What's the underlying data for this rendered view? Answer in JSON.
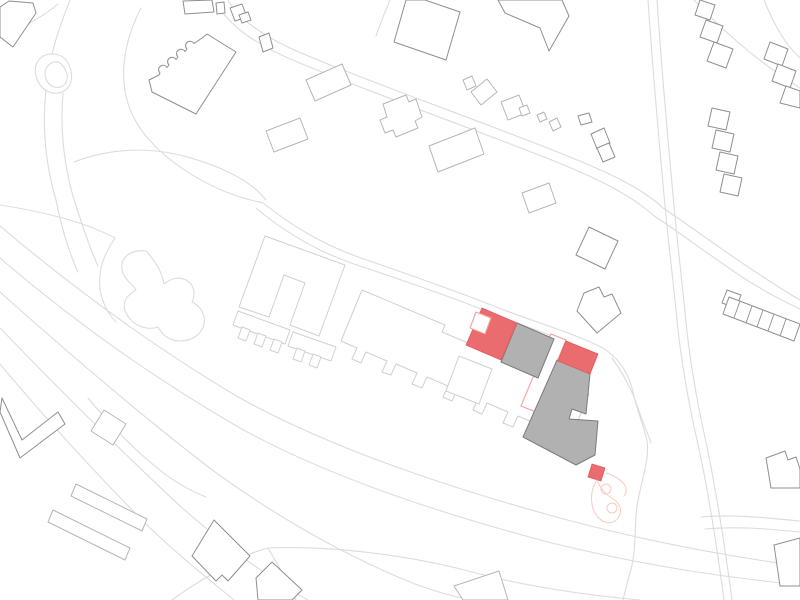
{
  "canvas": {
    "width": 800,
    "height": 600,
    "background": "#ffffff"
  },
  "palette": {
    "background": "#ffffff",
    "road_line": "#dcdcdc",
    "light_line": "#d0d0d0",
    "mid_line": "#b6b6b6",
    "dark_line": "#8f8f8f",
    "gray_fill": "#b1b1b1",
    "gray_stroke": "#7c7c7c",
    "red_fill": "#ea6c6e",
    "red_stroke": "#e05a5e",
    "salmon_line": "#efa49b",
    "pink_line": "#f6cabe"
  },
  "styles": {
    "road": {
      "stroke": "road_line",
      "fill": "none",
      "w": 1.1
    },
    "area": {
      "stroke": "road_line",
      "fill": "background",
      "w": 1.1
    },
    "light": {
      "stroke": "light_line",
      "fill": "background",
      "w": 1
    },
    "mid": {
      "stroke": "mid_line",
      "fill": "background",
      "w": 1
    },
    "dark": {
      "stroke": "dark_line",
      "fill": "background",
      "w": 1
    },
    "darkline": {
      "stroke": "dark_line",
      "fill": "none",
      "w": 0.9
    },
    "gray": {
      "stroke": "gray_stroke",
      "fill": "gray_fill",
      "w": 1
    },
    "red": {
      "stroke": "red_stroke",
      "fill": "red_fill",
      "w": 0.8
    },
    "salmon": {
      "stroke": "salmon_line",
      "fill": "background",
      "w": 1.1
    },
    "pink": {
      "stroke": "pink_line",
      "fill": "none",
      "w": 1
    }
  },
  "layers": [
    {
      "name": "roads",
      "items": [
        {
          "id": "road-approach-top-left",
          "style": "road",
          "d": "M 70,0 C 62,20 56,38 52,54"
        },
        {
          "id": "road-corner-line",
          "style": "road",
          "d": "M 0,38 C 22,28 44,16 58,4"
        },
        {
          "id": "road-culdesac-outer",
          "style": "road",
          "d": "M 52,54 C 40,54 33,64 36,76 C 39,89 51,96 62,92 C 72,88 74,76 69,65 C 66,58 60,54 52,54 Z"
        },
        {
          "id": "road-culdesac-island",
          "style": "road",
          "d": "M 54,62 C 47,64 43,71 46,79 C 49,87 58,90 64,85 C 69,81 68,72 63,66 C 60,62 57,61 54,62 Z"
        },
        {
          "id": "road-culdesac-stem-1",
          "style": "road",
          "d": "M 46,90 C 42,128 46,166 56,200 C 60,220 67,248 78,272"
        },
        {
          "id": "road-culdesac-stem-2",
          "style": "road",
          "d": "M 63,93 C 60,130 64,164 73,196 C 80,218 88,244 98,266"
        },
        {
          "id": "road-ring-around-kindergarten",
          "style": "road",
          "d": "M 141,8 C 122,45 117,85 134,118 C 150,149 190,179 234,195 C 245,199 255,201 263,203"
        },
        {
          "id": "road-path-upper",
          "style": "road",
          "d": "M 74,162 C 110,148 151,146 191,158 C 225,168 252,182 266,200"
        },
        {
          "id": "road-path-left-edge",
          "style": "road",
          "d": "M 0,205 C 45,212 85,222 115,238 C 108,249 101,261 100,275 C 98,292 104,310 116,322"
        },
        {
          "id": "road-main-street-1",
          "style": "road",
          "d": "M 228,0 C 236,16 261,36 301,53 C 380,86 480,121 560,153 C 600,169 640,186 663,208"
        },
        {
          "id": "road-main-street-2",
          "style": "road",
          "d": "M 218,5 C 228,24 254,44 295,61 C 374,94 474,129 554,161 C 594,177 630,194 653,215"
        },
        {
          "id": "road-main-street-1b",
          "style": "road",
          "d": "M 663,208 C 690,226 721,249 751,269 C 771,282 786,292 800,300"
        },
        {
          "id": "road-main-street-2b",
          "style": "road",
          "d": "M 653,215 C 680,233 711,256 742,277 C 762,290 781,300 800,309"
        },
        {
          "id": "road-branch-top",
          "style": "road",
          "d": "M 390,0 C 385,12 380,24 376,36"
        },
        {
          "id": "road-estate-1",
          "style": "road",
          "d": "M 263,203 C 291,225 321,244 361,258 C 401,272 451,289 491,305 C 531,321 571,332 601,347 C 619,357 629,374 633,392 C 637,411 644,426 647,441 C 650,459 641,481 637,506 C 634,527 637,553 629,576 C 627,584 625,592 623,600"
        },
        {
          "id": "road-estate-2",
          "style": "road",
          "d": "M 256,208 C 282,230 312,249 351,263 C 396,278 446,295 486,311 C 521,325 556,336 586,350"
        },
        {
          "id": "road-estate-3",
          "style": "road",
          "d": "M 612,358 C 622,372 631,388 637,405 C 641,418 647,431 651,443"
        },
        {
          "id": "road-parkway-1",
          "style": "road",
          "d": "M 0,226 C 70,285 150,345 240,398 C 330,448 450,488 560,518 C 660,545 740,558 800,566"
        },
        {
          "id": "road-parkway-2",
          "style": "road",
          "d": "M 0,258 C 70,318 150,376 240,428 C 330,478 445,515 552,543 C 650,567 724,577 800,585"
        },
        {
          "id": "road-parkway-3",
          "style": "road",
          "d": "M 0,292 C 65,350 140,415 215,472 C 290,526 355,560 415,584 C 440,593 462,599 476,600"
        },
        {
          "id": "road-parkway-4",
          "style": "road",
          "d": "M 0,328 C 55,385 120,450 180,506 C 230,550 272,580 308,600"
        },
        {
          "id": "road-parkway-5",
          "style": "road",
          "d": "M 0,364 C 45,418 100,478 150,528 C 188,564 215,584 234,600"
        },
        {
          "id": "road-connector-left",
          "style": "road",
          "d": "M 88,398 C 110,425 136,451 161,471 C 176,483 191,491 206,497"
        },
        {
          "id": "road-south-junction-a",
          "style": "road",
          "d": "M 172,600 C 183,592 195,584 207,577 C 231,562 252,552 268,548"
        },
        {
          "id": "road-south-junction-b",
          "style": "road",
          "d": "M 268,548 C 340,545 420,558 472,572 C 520,585 575,594 640,600"
        },
        {
          "id": "road-south-junction-c",
          "style": "road",
          "d": "M 268,548 C 278,565 288,582 296,600"
        },
        {
          "id": "road-highway-v-1",
          "style": "road",
          "d": "M 648,0 C 652,60 658,130 664,195 C 668,240 672,270 676,310 C 680,355 688,400 697,440 C 706,480 716,540 724,600"
        },
        {
          "id": "road-highway-v-2",
          "style": "road",
          "d": "M 657,0 C 661,60 667,130 673,195 C 677,240 681,272 685,312 C 689,357 697,402 706,442 C 714,480 724,540 732,600"
        },
        {
          "id": "road-east-1",
          "style": "road",
          "d": "M 701,517 C 734,514 768,518 800,521"
        },
        {
          "id": "road-east-2",
          "style": "road",
          "d": "M 705,529 C 737,526 770,529 800,532"
        },
        {
          "id": "road-tr-fence-1",
          "style": "road",
          "d": "M 694,0 C 720,28 753,57 786,79 C 791,82 796,85 800,88"
        },
        {
          "id": "road-tr-fence-2",
          "style": "road",
          "d": "M 764,0 C 773,22 783,42 800,58"
        }
      ]
    },
    {
      "name": "areas",
      "items": [
        {
          "id": "pond-blob",
          "style": "area",
          "d": "M 146,251 C 132,249 120,257 122,269 C 123,279 132,283 136,290 C 127,295 121,303 126,313 C 132,325 146,331 158,327 C 162,335 170,341 180,341 C 192,341 202,334 204,324 C 206,314 200,306 192,302 C 196,294 194,284 186,280 C 178,276 170,279 164,284 C 162,272 156,262 146,251 Z"
        }
      ]
    },
    {
      "name": "estate-light",
      "items": [
        {
          "id": "courtyard-building",
          "style": "light",
          "points": "265,236 345,265 319,336 290,325 305,283 284,275 269,317 239,307"
        },
        {
          "id": "slab-comb-building",
          "style": "light",
          "d": "M 362,290 L 445,325 L 442,332 L 589,394 L 571,437 L 548,429 L 543,440 L 534,436 L 539,425 L 518,416 L 513,427 L 503,423 L 508,412 L 487,403 L 482,414 L 473,410 L 478,399 L 457,390 L 452,401 L 443,397 L 448,386 L 427,377 L 422,388 L 412,384 L 417,373 L 396,364 L 391,375 L 382,372 L 387,361 L 366,352 L 361,363 L 352,359 L 357,348 L 341,341 Z"
        },
        {
          "id": "small-square-building",
          "style": "light",
          "points": "459,356 492,369 479,404 446,391"
        },
        {
          "id": "garage-bar-1",
          "style": "light",
          "points": "238,311 290,330 285,344 233,325"
        },
        {
          "id": "garage-tooth-1a",
          "style": "light",
          "points": "242,327 250,330 246,341 238,338"
        },
        {
          "id": "garage-tooth-1b",
          "style": "light",
          "points": "258,333 266,336 262,347 254,344"
        },
        {
          "id": "garage-tooth-1c",
          "style": "light",
          "points": "274,339 282,342 278,353 270,350"
        },
        {
          "id": "garage-bar-2",
          "style": "light",
          "points": "293,332 336,347 331,361 288,346"
        },
        {
          "id": "garage-tooth-2a",
          "style": "light",
          "points": "297,348 305,351 301,362 293,359"
        },
        {
          "id": "garage-tooth-2b",
          "style": "light",
          "points": "313,354 321,357 317,368 309,365"
        }
      ]
    },
    {
      "name": "mid-buildings",
      "items": [
        {
          "id": "rot-square-west",
          "style": "mid",
          "points": "104,410 126,424 113,445 91,431"
        },
        {
          "id": "thin-bar-1",
          "style": "mid",
          "points": "76,484 147,519 142,531 71,496"
        },
        {
          "id": "thin-bar-2",
          "style": "mid",
          "points": "53,510 130,548 125,560 48,522"
        },
        {
          "id": "block-row-1",
          "style": "mid",
          "points": "306,80 342,64 351,85 315,101"
        },
        {
          "id": "block-row-2",
          "style": "mid",
          "points": "266,131 300,118 308,139 274,152"
        },
        {
          "id": "notched-block",
          "style": "mid",
          "points": "383,104 406,95 409,102 416,99 422,117 415,121 418,128 396,137 393,130 385,133 380,120 387,117"
        },
        {
          "id": "block-row-4",
          "style": "mid",
          "points": "429,146 475,128 484,154 438,172"
        },
        {
          "id": "small-pair-a",
          "style": "mid",
          "points": "463,80 472,76 476,86 467,90"
        },
        {
          "id": "small-pair-b",
          "style": "mid",
          "points": "471,92 487,79 497,92 481,105"
        },
        {
          "id": "cluster-l",
          "style": "mid",
          "points": "501,102 519,95 526,113 508,120"
        },
        {
          "id": "cluster-l-annex",
          "style": "mid",
          "points": "519,108 527,105 530,113 522,116"
        },
        {
          "id": "tiny-square-1",
          "style": "mid",
          "points": "537,115 544,112 547,119 540,122"
        },
        {
          "id": "tiny-square-2",
          "style": "mid",
          "points": "549,122 557,118 561,127 553,131"
        },
        {
          "id": "mid-parallelogram",
          "style": "mid",
          "points": "522,193 549,183 556,203 529,213"
        },
        {
          "id": "bottom-partial-building",
          "style": "mid",
          "points": "454,586 499,571 508,600 463,600"
        }
      ]
    },
    {
      "name": "dark-buildings",
      "items": [
        {
          "id": "corner-pentagon",
          "style": "dark",
          "points": "0,7 9,1 33,3 36,13 13,47 0,37"
        },
        {
          "id": "scalloped-building",
          "style": "dark",
          "d": "M 207,34 L 236,52 L 196,114 L 152,92 L 149,80 L 159,75 l 1,-2 a 4.5,4.5 0 1 1 7,-5.5 l 2,-2.5 a 4.5,4.5 0 1 1 7,-5.5 l 2,-2.5 a 4.5,4.5 0 1 1 7,-5.5 l 2,-2.5 a 4.5,4.5 0 1 1 7,-5.5 L 202,38 Z"
        },
        {
          "id": "top-rect-1",
          "style": "dark",
          "points": "183,1 212,0 214,12 185,14"
        },
        {
          "id": "top-rect-2",
          "style": "dark",
          "points": "216,3 224,2 225,13 217,14"
        },
        {
          "id": "top-l-main",
          "style": "dark",
          "points": "230,8 242,4 247,17 235,21"
        },
        {
          "id": "top-l-flag",
          "style": "dark",
          "points": "239,15 248,12 251,20 242,23"
        },
        {
          "id": "small-rect-a",
          "style": "dark",
          "points": "259,37 269,33 273,48 263,52"
        },
        {
          "id": "big-top-center",
          "style": "dark",
          "points": "425,0 460,12 446,60 394,42 406,0"
        },
        {
          "id": "top-flag-building",
          "style": "dark",
          "points": "498,0 562,0 569,16 549,51 540,28 505,13"
        },
        {
          "id": "step-z1a",
          "style": "dark",
          "points": "700,0 715,5 710,20 695,15"
        },
        {
          "id": "step-z1b",
          "style": "dark",
          "points": "706,20 723,26 717,43 700,37"
        },
        {
          "id": "step-z1c",
          "style": "dark",
          "points": "714,42 733,49 726,68 707,61"
        },
        {
          "id": "step-z2a",
          "style": "dark",
          "points": "770,42 788,49 782,66 764,59"
        },
        {
          "id": "step-z2b",
          "style": "dark",
          "points": "778,64 796,71 790,88 772,81"
        },
        {
          "id": "step-z2c",
          "style": "dark",
          "points": "786,86 800,91 800,108 780,103"
        },
        {
          "id": "step-z3a",
          "style": "dark",
          "points": "712,108 730,112 726,130 708,126"
        },
        {
          "id": "step-z3b",
          "style": "dark",
          "points": "716,130 734,134 730,152 712,148"
        },
        {
          "id": "step-z3c",
          "style": "dark",
          "points": "720,152 738,156 734,174 716,170"
        },
        {
          "id": "step-z3d",
          "style": "dark",
          "points": "724,174 742,178 738,196 720,192"
        },
        {
          "id": "house-square",
          "style": "dark",
          "points": "578,116 589,113 592,122 581,125"
        },
        {
          "id": "house-pair-a",
          "style": "dark",
          "points": "591,134 604,128 610,143 597,149"
        },
        {
          "id": "house-pair-b",
          "style": "dark",
          "points": "597,148 609,143 615,157 603,162"
        },
        {
          "id": "rot-square-east",
          "style": "dark",
          "points": "589,227 618,241 605,269 576,255"
        },
        {
          "id": "notched-east-building",
          "style": "dark",
          "points": "584,293 599,287 604,297 612,294 621,313 597,333 577,311"
        },
        {
          "id": "rowhouse-end-block",
          "style": "dark",
          "points": "727,290 741,295 736,308 722,303"
        },
        {
          "id": "rowhouse-bar",
          "style": "dark",
          "points": "729,297 800,324 794,341 723,314"
        },
        {
          "id": "rowhouse-div-1",
          "style": "darkline",
          "d": "M 740,301 L 734,318"
        },
        {
          "id": "rowhouse-div-2",
          "style": "darkline",
          "d": "M 752,306 L 746,323"
        },
        {
          "id": "rowhouse-div-3",
          "style": "darkline",
          "d": "M 763,310 L 757,327"
        },
        {
          "id": "rowhouse-div-4",
          "style": "darkline",
          "d": "M 774,314 L 768,331"
        },
        {
          "id": "rowhouse-div-5",
          "style": "darkline",
          "d": "M 786,319 L 780,336"
        },
        {
          "id": "notched-se-building",
          "style": "dark",
          "points": "766,458 785,451 788,460 796,457 800,469 800,488 771,488"
        },
        {
          "id": "corner-se-building",
          "style": "dark",
          "points": "774,545 800,538 800,586 780,586"
        },
        {
          "id": "bl-house-1",
          "style": "dark",
          "points": "214,520 250,556 228,581 222,575 216,581 192,556"
        },
        {
          "id": "bl-house-2",
          "style": "dark",
          "points": "272,562 302,590 292,600 258,600 256,578"
        },
        {
          "id": "v-building",
          "style": "dark",
          "points": "2,398 22,440 58,412 65,424 20,458 0,412"
        }
      ]
    },
    {
      "name": "site-highlight",
      "items": [
        {
          "id": "proposed-strip-outline",
          "style": "salmon",
          "points": "551,334 566,340 536,412 521,406"
        },
        {
          "id": "existing-gray-mid",
          "style": "gray",
          "points": "517,323 554,339 538,378 501,362"
        },
        {
          "id": "existing-gray-main",
          "style": "gray",
          "points": "557,360 590,374 586,414 572,409 569,419 598,421 595,455 576,465 523,437"
        },
        {
          "id": "new-red-west",
          "style": "red",
          "points": "482,308 517,323 501,360 466,345"
        },
        {
          "id": "new-red-mid",
          "style": "red",
          "points": "566,341 598,354 590,374 558,361"
        },
        {
          "id": "new-red-small",
          "style": "red",
          "points": "592,464 605,468 601,481 588,477"
        },
        {
          "id": "notch-outline",
          "style": "salmon",
          "points": "476,312 491,318 485,334 470,328"
        },
        {
          "id": "playground-loop",
          "style": "pink",
          "d": "M 597,480 C 589,492 590,508 598,517 C 604,524 613,525 618,518 C 623,511 620,503 613,499 C 605,494 600,488 597,480 Z"
        },
        {
          "id": "playground-circle-1",
          "style": "pink",
          "circle": [
            606,
            489,
            5
          ]
        },
        {
          "id": "playground-circle-2",
          "style": "pink",
          "circle": [
            612,
            508,
            5
          ]
        },
        {
          "id": "playground-connector",
          "style": "pink",
          "d": "M 606,473 C 613,475 620,479 624,484 C 627,488 627,493 624,496"
        }
      ]
    }
  ]
}
